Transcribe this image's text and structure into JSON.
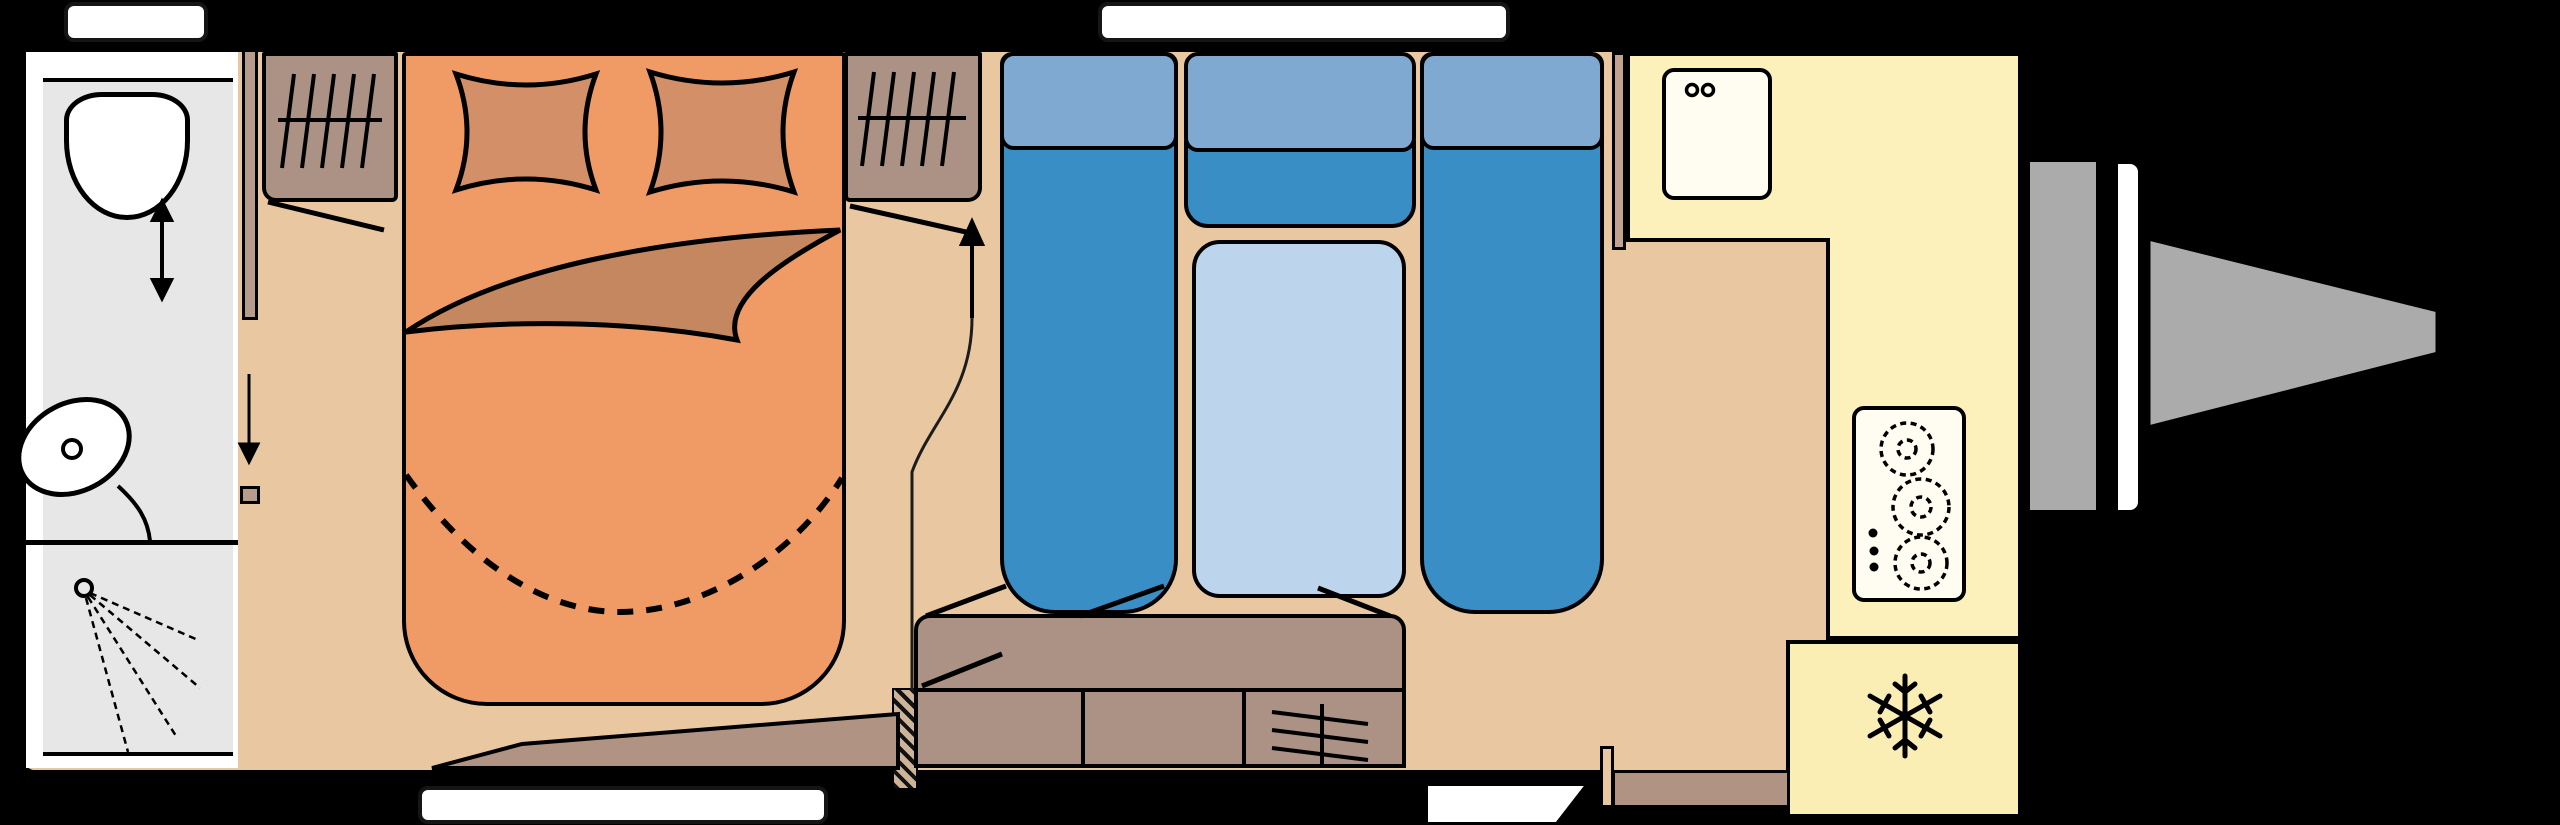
{
  "page": {
    "kind": "caravan floor plan diagram",
    "title": "Caravan interior layout, side profile plan view"
  },
  "colors": {
    "background": "#000000",
    "outline": "#000000",
    "floor": "#e9c7a0",
    "bed": "#f09a66",
    "pillow": "#d28f68",
    "blanket": "#c4875f",
    "furniture_wood": "#ab9284",
    "partition_wood": "#b59c8d",
    "seat_blue": "#3a8ec6",
    "seat_back_blue": "#7fa9d1",
    "table_blue": "#bcd4ec",
    "kitchen_yellow": "#fcf1bb",
    "fridge_yellow": "#fbeeb4",
    "appliance_white": "#fffdf2",
    "bathroom_floor": "#e7e7e7",
    "bathroom_white": "#ffffff",
    "exterior_gray": "#ababab",
    "window_white": "#ffffff"
  },
  "icons": {
    "snowflake-icon": "snowflake (fridge/freezer)",
    "hob-icon": "3-burner hob with 3 control knobs",
    "sink-icon": "kitchen sink with two tap dots",
    "hanging-rail-icon": "wardrobe hanging rail with 5 hangers",
    "toilet-icon": "toilet bowl",
    "washbasin-icon": "washbasin with drain",
    "shower-icon": "shower head with 4 spray lines",
    "sliding-door-arrow-icon": "double-headed vertical arrow",
    "down-arrow-icon": "downward arrow",
    "entry-arrow-icon": "upward arrow with curved walk-in path",
    "door-swing-icon": "diagonal door-opening tick",
    "vent-icon": "grille of 3 crossed slats",
    "drawbar-icon": "A-frame towing hitch",
    "window-icon": "white window bar",
    "entry-step-icon": "white entrance step"
  },
  "counts": {
    "burners": 3,
    "dinette_seats": 3,
    "wardrobes": 2,
    "windows": 3
  }
}
